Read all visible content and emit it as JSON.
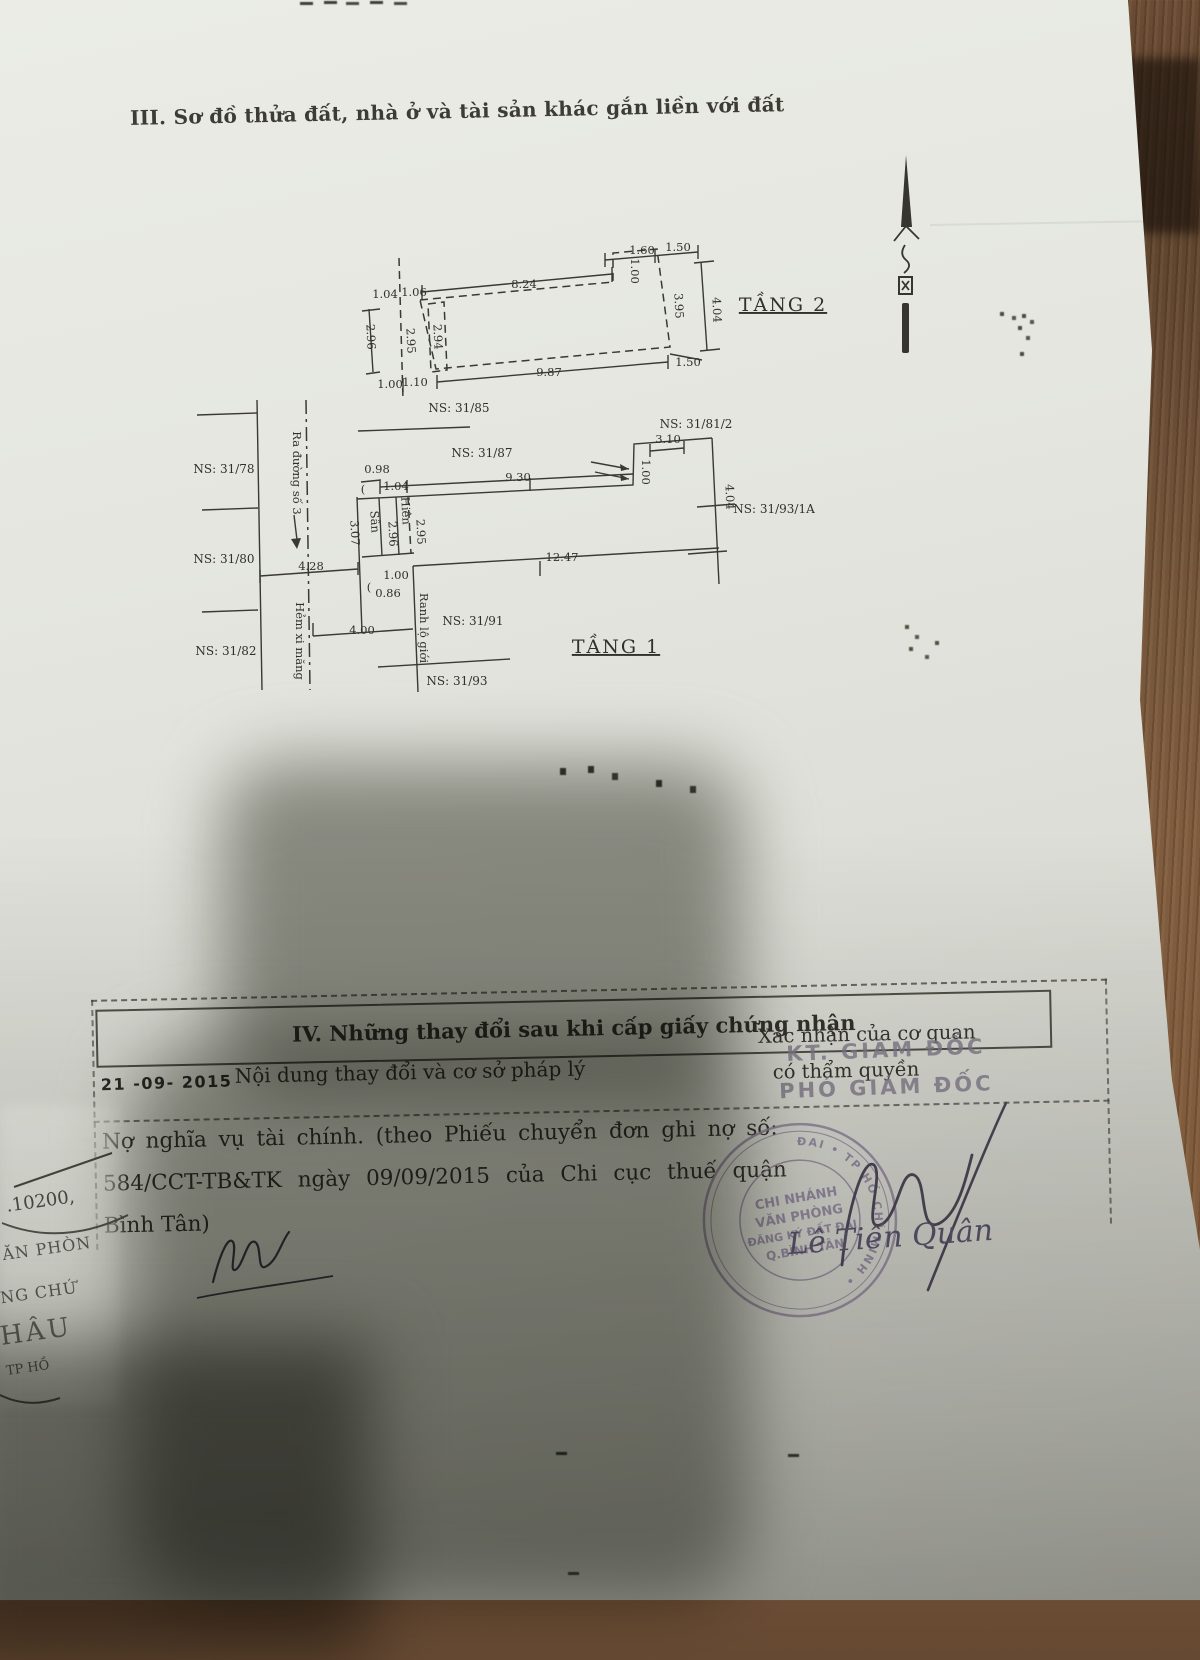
{
  "colors": {
    "paper": "#e4e5df",
    "wood": "#75563b",
    "ink": "#34332d",
    "seal_purple": "#8b7e99",
    "signature_ink": "#4c4656"
  },
  "page": {
    "section3_title": "III. Sơ đồ thửa đất, nhà ở và tài sản khác gắn liền với đất"
  },
  "diagram": {
    "labels": [
      {
        "t": "1.60",
        "x": 492,
        "y": 44
      },
      {
        "t": "1.50",
        "x": 528,
        "y": 41
      },
      {
        "t": "8.24",
        "x": 374,
        "y": 78
      },
      {
        "t": "1.00",
        "x": 481,
        "y": 61,
        "r": 90
      },
      {
        "t": "3.95",
        "x": 525,
        "y": 96,
        "r": 87
      },
      {
        "t": "4.04",
        "x": 563,
        "y": 100,
        "r": 88
      },
      {
        "t": "1.50",
        "x": 538,
        "y": 156
      },
      {
        "t": "9.87",
        "x": 399,
        "y": 166
      },
      {
        "t": "1.04",
        "x": 235,
        "y": 88
      },
      {
        "t": "1.06",
        "x": 264,
        "y": 86
      },
      {
        "t": "2.96",
        "x": 217,
        "y": 127,
        "r": 87
      },
      {
        "t": "2.95",
        "x": 257,
        "y": 131,
        "r": 87
      },
      {
        "t": "2.94",
        "x": 284,
        "y": 127,
        "r": 87
      },
      {
        "t": "1.00",
        "x": 240,
        "y": 178
      },
      {
        "t": "1.10",
        "x": 265,
        "y": 176
      },
      {
        "t": "TẦNG 2",
        "x": 633,
        "y": 101,
        "cls": "big"
      },
      {
        "t": "NS: 31/85",
        "x": 309,
        "y": 202,
        "cls": "ns"
      },
      {
        "t": "NS: 31/87",
        "x": 332,
        "y": 247,
        "cls": "ns"
      },
      {
        "t": "NS: 31/81/2",
        "x": 546,
        "y": 218,
        "cls": "ns"
      },
      {
        "t": "3.10",
        "x": 518,
        "y": 233
      },
      {
        "t": "1.00",
        "x": 492,
        "y": 262,
        "r": 90
      },
      {
        "t": "9.30",
        "x": 368,
        "y": 271
      },
      {
        "t": "0.98",
        "x": 227,
        "y": 263
      },
      {
        "t": "1.04",
        "x": 246,
        "y": 280
      },
      {
        "t": "(",
        "x": 213,
        "y": 283
      },
      {
        "t": "4.04",
        "x": 576,
        "y": 287,
        "r": 88
      },
      {
        "t": "NS: 31/93/1A",
        "x": 624,
        "y": 303,
        "cls": "ns"
      },
      {
        "t": "NS: 31/78",
        "x": 74,
        "y": 263,
        "cls": "ns"
      },
      {
        "t": "NS: 31/80",
        "x": 74,
        "y": 353,
        "cls": "ns"
      },
      {
        "t": "NS: 31/82",
        "x": 76,
        "y": 445,
        "cls": "ns"
      },
      {
        "t": "Ra đường số 3",
        "x": 143,
        "y": 263,
        "r": 90
      },
      {
        "t": "Hẻm xi măng",
        "x": 146,
        "y": 431,
        "r": 90
      },
      {
        "t": "4.28",
        "x": 161,
        "y": 360
      },
      {
        "t": "3.07",
        "x": 201,
        "y": 323,
        "r": 87
      },
      {
        "t": "Sân",
        "x": 221,
        "y": 312,
        "r": 87
      },
      {
        "t": "Hiên",
        "x": 252,
        "y": 301,
        "r": 87
      },
      {
        "t": "2.96",
        "x": 239,
        "y": 324,
        "r": 87
      },
      {
        "t": "2.95",
        "x": 267,
        "y": 322,
        "r": 87
      },
      {
        "t": "12.47",
        "x": 412,
        "y": 351
      },
      {
        "t": "1.00",
        "x": 246,
        "y": 369
      },
      {
        "t": "0.86",
        "x": 238,
        "y": 387
      },
      {
        "t": "(",
        "x": 219,
        "y": 381
      },
      {
        "t": "Ranh lộ giới",
        "x": 270,
        "y": 418,
        "r": 90
      },
      {
        "t": "NS: 31/91",
        "x": 323,
        "y": 415,
        "cls": "ns"
      },
      {
        "t": "TẦNG 1",
        "x": 466,
        "y": 443,
        "cls": "big"
      },
      {
        "t": "NS: 31/93",
        "x": 307,
        "y": 475,
        "cls": "ns"
      },
      {
        "t": "4.00",
        "x": 212,
        "y": 424
      }
    ]
  },
  "section4": {
    "title": "IV. Những thay đổi sau khi cấp giấy chứng nhận",
    "date_stamp": "21 -09- 2015",
    "content_header": "Nội dung thay đổi và cơ sở pháp lý",
    "confirm_line1": "Xác nhận của cơ quan",
    "confirm_line2": "có thẩm quyền",
    "stamp_kt": "KT. GIÁM ĐỐC",
    "stamp_pho": "PHÓ GIÁM ĐỐC",
    "body_line1": "Nợ nghĩa vụ tài chính. (theo Phiếu chuyển đơn ghi nợ số:",
    "body_line2": "584/CCT-TB&TK ngày 09/09/2015 của Chi cục thuế quận",
    "body_line3": "Bình Tân)",
    "signature_name": "Lê Tiến Quân"
  },
  "seal": {
    "ring": "VĂN PHÒNG ĐĂNG KÝ ĐẤT ĐAI • TP HỒ CHÍ MINH •",
    "line1": "CHI NHÁNH",
    "line2": "VĂN PHÒNG",
    "line3": "ĐĂNG KÝ ĐẤT ĐAI",
    "line4": "Q.BÌNH TÂN"
  },
  "fragment": {
    "number": ".10200,",
    "line1": "ĂN PHÒN",
    "line2": "NG CHỨ",
    "line3": "HÂU",
    "line4": "TP HỒ"
  }
}
